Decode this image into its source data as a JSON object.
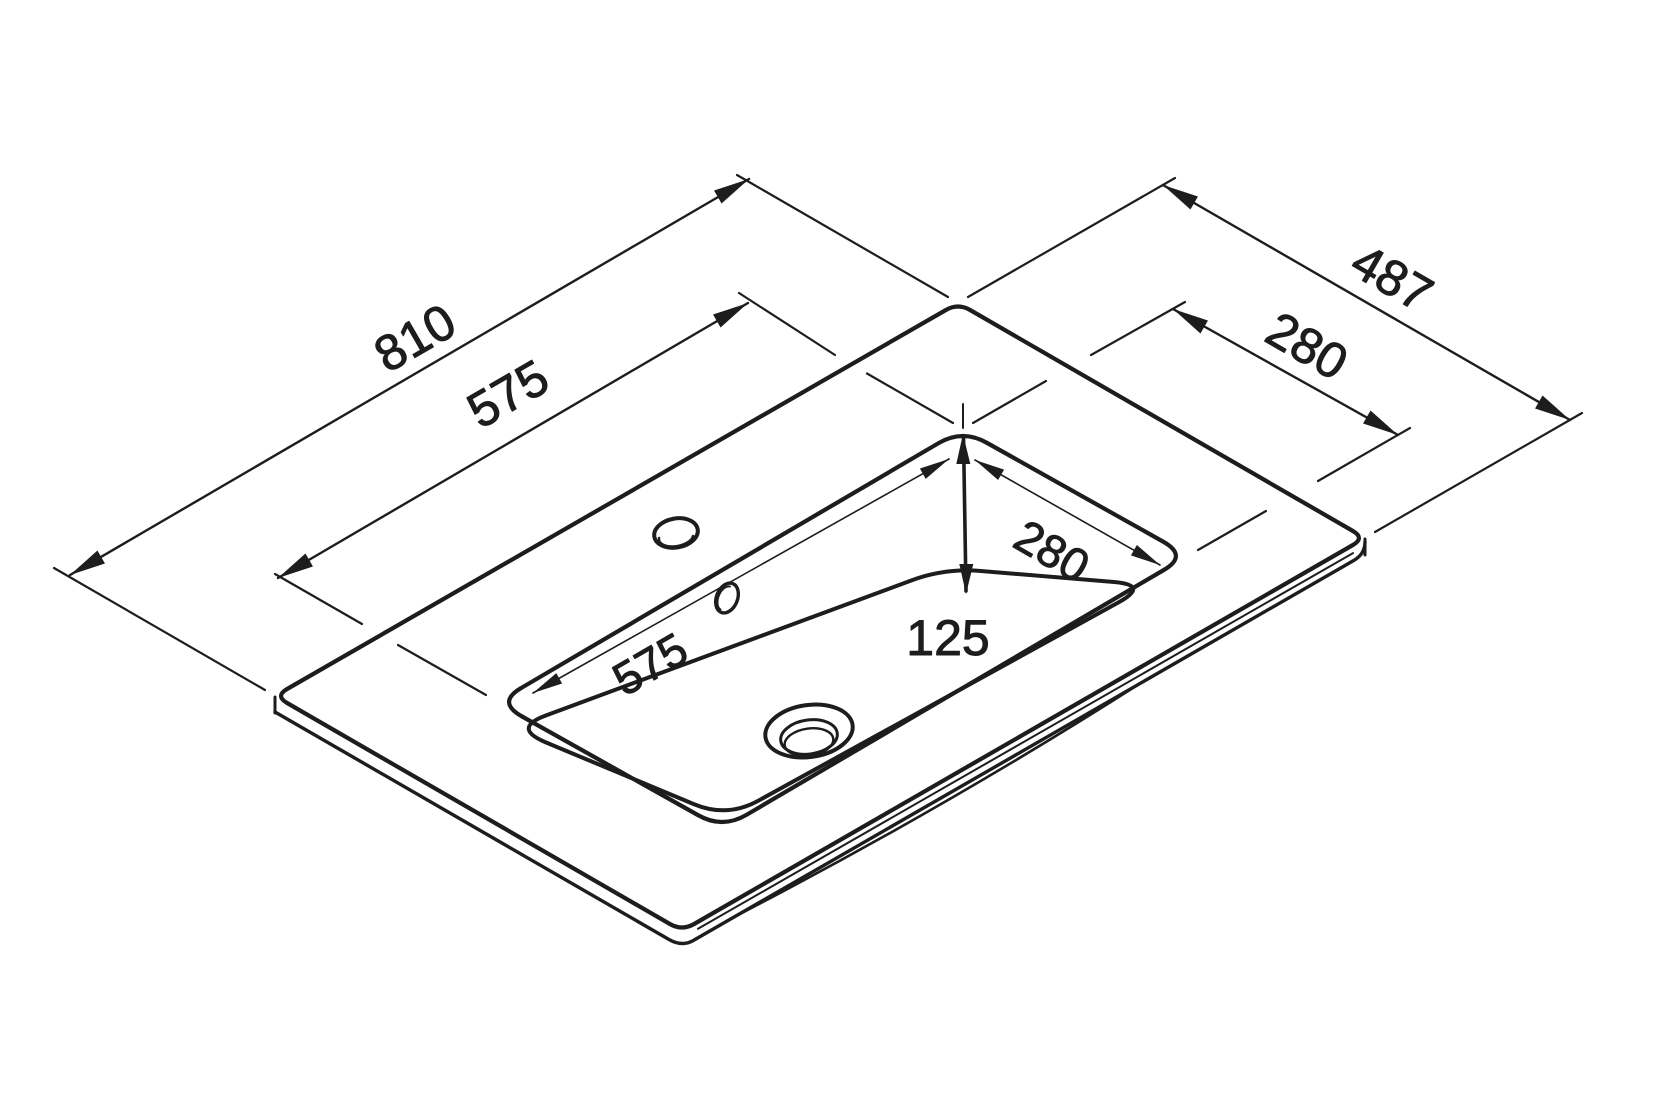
{
  "drawing": {
    "background_color": "#ffffff",
    "line_color": "#1d1d1b",
    "labels": {
      "countertop_length": "810",
      "countertop_width": "487",
      "cutout_length": "575",
      "cutout_width": "280",
      "basin_length": "575",
      "basin_width": "280",
      "basin_depth": "125"
    }
  }
}
